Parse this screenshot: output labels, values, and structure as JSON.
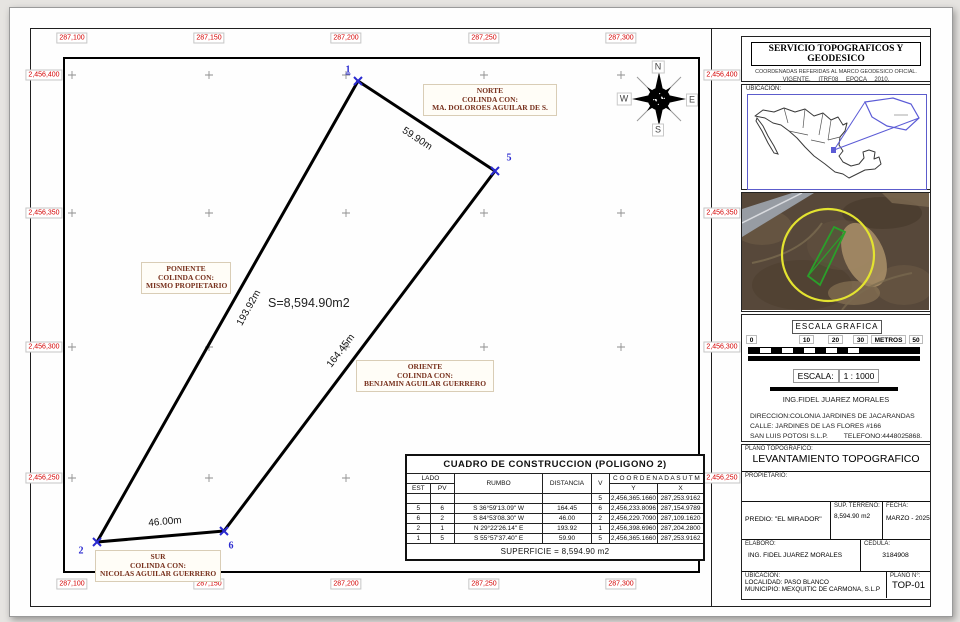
{
  "drawing": {
    "top_coords": [
      "287,100",
      "287,150",
      "287,200",
      "287,250",
      "287,300"
    ],
    "bottom_coords": [
      "287,100",
      "287,150",
      "287,200",
      "287,250",
      "287,300"
    ],
    "left_coords": [
      "2,456,400",
      "2,456,350",
      "2,456,300",
      "2,456,250"
    ],
    "right_coords": [
      "2,456,400",
      "2,456,350",
      "2,456,300",
      "2,456,250"
    ],
    "area_label": "S=8,594.90m2",
    "side_labels": {
      "north": "59.90m",
      "east": "164.45m",
      "west": "193.92m",
      "south": "46.00m"
    },
    "vertex_labels": {
      "v1": "1",
      "v5": "5",
      "v6": "6",
      "v2": "2"
    },
    "boundaries": {
      "north": [
        "NORTE",
        "COLINDA CON:",
        "MA. DOLOROES AGUILAR DE S."
      ],
      "west": [
        "PONIENTE",
        "COLINDA CON:",
        "MISMO PROPIETARIO"
      ],
      "east": [
        "ORIENTE",
        "COLINDA CON:",
        "BENJAMIN AGUILAR GUERRERO"
      ],
      "south": [
        "SUR",
        "COLINDA CON:",
        "NICOLAS AGUILAR GUERRERO"
      ]
    },
    "compass": {
      "n": "N",
      "s": "S",
      "e": "E",
      "w": "W"
    }
  },
  "table": {
    "title": "CUADRO DE CONSTRUCCION (POLIGONO 2)",
    "headers": {
      "lado": "LADO",
      "est": "EST",
      "pv": "PV",
      "rumbo": "RUMBO",
      "distancia": "DISTANCIA",
      "v": "V",
      "coordenadas": "C O O R D E N A D A S  U T M",
      "y": "Y",
      "x": "X"
    },
    "rows": [
      [
        "",
        "",
        "",
        "",
        "5",
        "2,456,365.1660",
        "287,253.9162"
      ],
      [
        "5",
        "6",
        "S 36°59'13.09\" W",
        "164.45",
        "6",
        "2,456,233.8096",
        "287,154.9789"
      ],
      [
        "6",
        "2",
        "S 84°53'08.30\" W",
        "46.00",
        "2",
        "2,456,229.7090",
        "287,109.1620"
      ],
      [
        "2",
        "1",
        "N 29°22'26.14\" E",
        "193.92",
        "1",
        "2,456,398.6960",
        "287,204.2800"
      ],
      [
        "1",
        "5",
        "S 55°57'37.40\" E",
        "59.90",
        "5",
        "2,456,365.1660",
        "287,253.9162"
      ]
    ],
    "footer": "SUPERFICIE = 8,594.90 m2"
  },
  "sidebar": {
    "header": {
      "title": "SERVICIO TOPOGRAFICOS Y GEODESICO",
      "line1": "COORDENADAS REFERIDAS AL MARCO GEODESICO OFICIAL.",
      "line2": "VIGENTE. ITRF08 EPOCA 2010."
    },
    "ubicacion_label": "UBICACION:",
    "escala": {
      "title": "ESCALA GRAFICA",
      "ticks": [
        "0",
        "10",
        "20",
        "30",
        "METROS",
        "50"
      ],
      "escala_label": "ESCALA:",
      "escala_value": "1 : 1000",
      "engineer": "ING.FIDEL JUAREZ MORALES",
      "address1": "DIRECCION:COLONIA JARDINES DE JACARANDAS",
      "address2": "CALLE: JARDINES DE LAS FLORES  #166",
      "address3": "SAN LUIS POTOSI S.L.P.",
      "phone": "TELEFONO:4448025868."
    },
    "titleblock": {
      "plano_label": "PLANO TOPOGRAFICO:",
      "plano_title": "LEVANTAMIENTO TOPOGRAFICO",
      "propietario_label": "PROPIETARIO:",
      "predio": "PREDIO: \"EL MIRADOR\"",
      "sup_label": "SUP. TERRENO:",
      "sup_value": "8,594.90 m2",
      "fecha_label": "FECHA:",
      "fecha_value": "MARZO - 2025",
      "elaboro_label": "ELABORO:",
      "elaboro_value": "ING. FIDEL JUAREZ MORALES",
      "cedula_label": "CEDULA:",
      "cedula_value": "3184908",
      "ubicacion_label": "UBICACION:",
      "localidad": "LOCALIDAD: PASO BLANCO",
      "municipio": "MUNICIPIO:  MEXQUITIC DE CARMONA, S.L.P",
      "plano_no_label": "PLANO N°:",
      "plano_no": "TOP-01"
    }
  }
}
